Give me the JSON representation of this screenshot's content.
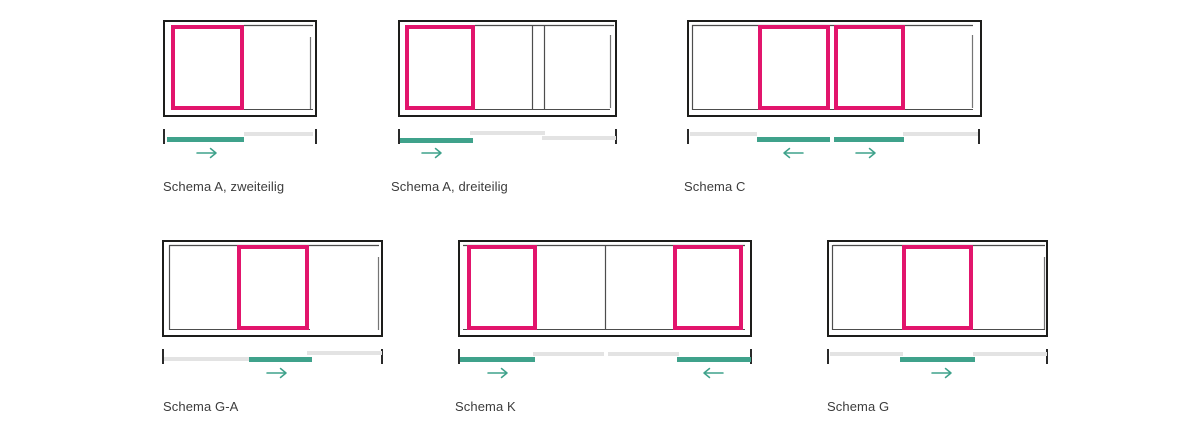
{
  "page": {
    "background": "#ffffff",
    "description_labels": {
      "row1": [
        "Schema A, zweiteilig",
        "Schema A, dreiteilig",
        "Schema C"
      ],
      "row2": [
        "Schema G-A",
        "Schema K",
        "Schema G"
      ]
    }
  },
  "colors": {
    "sliding_panel_pink": "#e2156c",
    "track_active_teal": "#3fa28b",
    "track_fixed_gray": "#e3e3e3",
    "frame_black": "#1d1d1b",
    "thin_line": "#4d4d4d",
    "label_text": "#3c3c3c"
  },
  "schemas": [
    {
      "id": "schema-a-zweiteilig",
      "label": "Schema A, zweiteilig",
      "sliding_panels": 1,
      "arrows": [
        "right"
      ]
    },
    {
      "id": "schema-a-dreiteilig",
      "label": "Schema A, dreiteilig",
      "sliding_panels": 1,
      "arrows": [
        "right"
      ]
    },
    {
      "id": "schema-c",
      "label": "Schema C",
      "sliding_panels": 2,
      "arrows": [
        "left",
        "right"
      ]
    },
    {
      "id": "schema-g-a",
      "label": "Schema G-A",
      "sliding_panels": 1,
      "arrows": [
        "right"
      ]
    },
    {
      "id": "schema-k",
      "label": "Schema K",
      "sliding_panels": 2,
      "arrows": [
        "right",
        "left"
      ]
    },
    {
      "id": "schema-g",
      "label": "Schema G",
      "sliding_panels": 1,
      "arrows": [
        "right"
      ]
    }
  ]
}
